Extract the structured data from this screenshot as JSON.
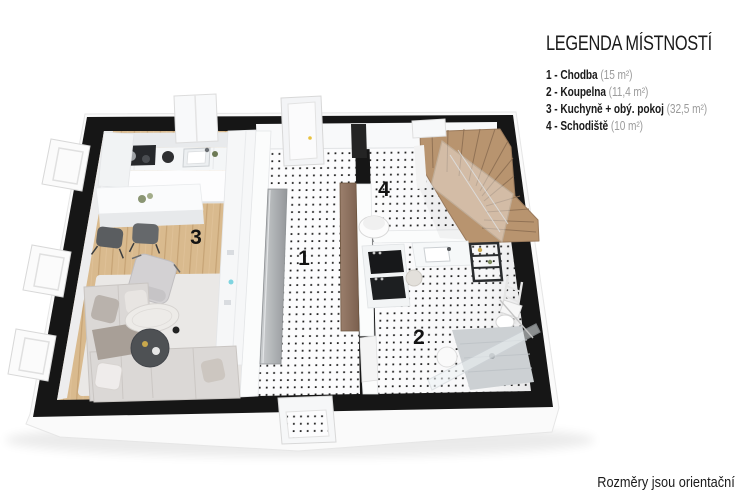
{
  "legend": {
    "title": "LEGENDA MÍSTNOSTÍ",
    "items": [
      {
        "label": "1 - Chodba",
        "area": "(15 m²)"
      },
      {
        "label": "2 - Koupelna",
        "area": "(11,4 m²)"
      },
      {
        "label": "3 - Kuchyně + obý. pokoj",
        "area": "(32,5 m²)"
      },
      {
        "label": "4 - Schodiště",
        "area": "(10 m²)"
      }
    ]
  },
  "plan": {
    "room_labels": {
      "hallway": "1",
      "bathroom": "2",
      "living": "3",
      "stairs": "4"
    }
  },
  "footer": {
    "disclaimer": "Rozměry jsou orientační"
  },
  "colors": {
    "wall_black": "#161616",
    "wood_floor": "#d9ba8e",
    "stair_brown": "#b8946f",
    "wardrobe_brown": "#8d7261",
    "wardrobe_silver": "#aeb1b4",
    "dot": "#222222",
    "rug": "#eae8e6",
    "text": "#1a1a1a",
    "muted_text": "#9b9b9b"
  }
}
